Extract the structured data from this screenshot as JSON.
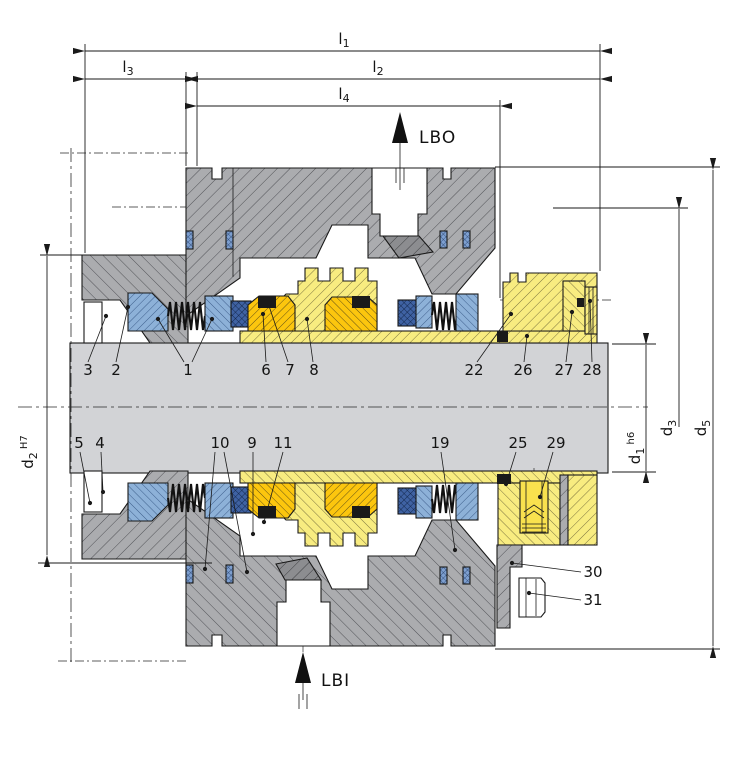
{
  "diagram": {
    "type": "technical-drawing",
    "subject": "dual mechanical cartridge seal - shaft cross-section",
    "dim_labels": {
      "l1": {
        "main": "l",
        "sub": "1",
        "suffix": ""
      },
      "l2": {
        "main": "l",
        "sub": "2",
        "suffix": ""
      },
      "l3": {
        "main": "l",
        "sub": "3",
        "suffix": ""
      },
      "l4": {
        "main": "l",
        "sub": "4",
        "suffix": ""
      },
      "d1": {
        "main": "d",
        "sub": "1",
        "suffix": " h6"
      },
      "d2": {
        "main": "d",
        "sub": "2",
        "suffix": " H7"
      },
      "d3": {
        "main": "d",
        "sub": "3",
        "suffix": ""
      },
      "d5": {
        "main": "d",
        "sub": "5",
        "suffix": ""
      }
    },
    "ports": {
      "lbo": "LBO",
      "lbi": "LBI"
    },
    "part_labels": [
      {
        "n": "1",
        "x": 188,
        "y": 375,
        "leaders": [
          [
            184,
            362,
            158,
            319
          ],
          [
            192,
            362,
            212,
            319
          ]
        ]
      },
      {
        "n": "2",
        "x": 116,
        "y": 375,
        "leaders": [
          [
            116,
            362,
            128,
            307
          ]
        ]
      },
      {
        "n": "3",
        "x": 88,
        "y": 375,
        "leaders": [
          [
            88,
            362,
            106,
            316
          ]
        ]
      },
      {
        "n": "4",
        "x": 100,
        "y": 448,
        "leaders": [
          [
            101,
            452,
            103,
            492
          ]
        ]
      },
      {
        "n": "5",
        "x": 79,
        "y": 448,
        "leaders": [
          [
            80,
            452,
            90,
            503
          ]
        ]
      },
      {
        "n": "6",
        "x": 266,
        "y": 375,
        "leaders": [
          [
            266,
            362,
            263,
            314
          ]
        ]
      },
      {
        "n": "7",
        "x": 290,
        "y": 375,
        "leaders": [
          [
            288,
            362,
            269,
            306
          ]
        ]
      },
      {
        "n": "8",
        "x": 314,
        "y": 375,
        "leaders": [
          [
            313,
            362,
            307,
            319
          ]
        ]
      },
      {
        "n": "9",
        "x": 252,
        "y": 448,
        "leaders": [
          [
            253,
            452,
            253,
            534
          ]
        ]
      },
      {
        "n": "10",
        "x": 220,
        "y": 448,
        "leaders": [
          [
            215,
            452,
            205,
            569
          ],
          [
            224,
            452,
            247,
            572
          ]
        ]
      },
      {
        "n": "11",
        "x": 283,
        "y": 448,
        "leaders": [
          [
            283,
            452,
            264,
            522
          ]
        ]
      },
      {
        "n": "19",
        "x": 440,
        "y": 448,
        "leaders": [
          [
            441,
            452,
            455,
            550
          ]
        ]
      },
      {
        "n": "22",
        "x": 474,
        "y": 375,
        "leaders": [
          [
            477,
            362,
            511,
            314
          ]
        ]
      },
      {
        "n": "25",
        "x": 518,
        "y": 448,
        "leaders": [
          [
            516,
            452,
            506,
            484
          ]
        ]
      },
      {
        "n": "26",
        "x": 523,
        "y": 375,
        "leaders": [
          [
            524,
            362,
            527,
            336
          ]
        ]
      },
      {
        "n": "27",
        "x": 564,
        "y": 375,
        "leaders": [
          [
            566,
            362,
            572,
            312
          ]
        ]
      },
      {
        "n": "28",
        "x": 592,
        "y": 375,
        "leaders": [
          [
            592,
            362,
            590,
            301
          ]
        ]
      },
      {
        "n": "29",
        "x": 556,
        "y": 448,
        "leaders": [
          [
            553,
            452,
            540,
            497
          ]
        ]
      },
      {
        "n": "30",
        "x": 593,
        "y": 577,
        "leaders": [
          [
            581,
            572,
            512,
            563
          ]
        ]
      },
      {
        "n": "31",
        "x": 593,
        "y": 605,
        "leaders": [
          [
            581,
            600,
            529,
            593
          ]
        ]
      }
    ],
    "colors": {
      "housing_gray": "#abacaf",
      "dark_gray": "#8c8d90",
      "shaft_gray": "#d2d3d6",
      "sleeve_yellow": "#f8ec80",
      "seal_face_gold": "#fcc60e",
      "ring_blue": "#8db1d8",
      "oring_dark_blue": "#3f62a3",
      "joint_oring_blue": "#7d9fd0",
      "elastomer_black": "#1a1a1a",
      "line": "#1a1a1a"
    }
  }
}
